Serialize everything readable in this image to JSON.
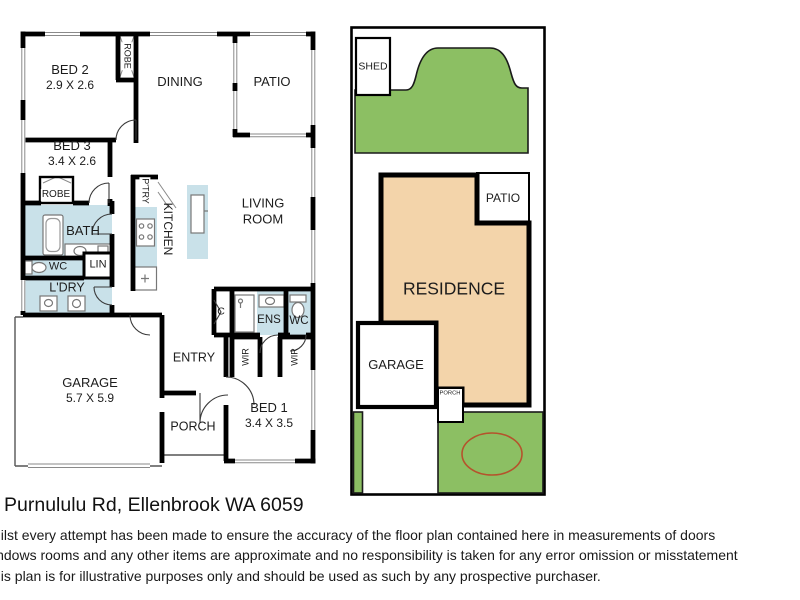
{
  "address": "Purnululu Rd, Ellenbrook WA 6059",
  "disclaimer": {
    "line1": "hilst every attempt has been made to ensure the accuracy of the floor plan contained here in measurements of doors",
    "line2": "indows rooms and any other items are approximate and no responsibility is taken for any error omission or misstatement",
    "line3": "his plan is for illustrative purposes only and should be used as such by any prospective purchaser."
  },
  "floor_plan": {
    "bed2": {
      "name": "BED 2",
      "dims": "2.9 X 2.6"
    },
    "bed3": {
      "name": "BED 3",
      "dims": "3.4 X 2.6"
    },
    "bed1": {
      "name": "BED 1",
      "dims": "3.4 X 3.5"
    },
    "garage": {
      "name": "GARAGE",
      "dims": "5.7 X 5.9"
    },
    "dining": "DINING",
    "patio": "PATIO",
    "living": "LIVING ROOM",
    "kitchen": "KITCHEN",
    "pantry": "P'TRY",
    "robe_top": "ROBE",
    "robe_bed3": "ROBE",
    "bath": "BATH",
    "wc": "WC",
    "linen": "LIN",
    "laundry": "L'DRY",
    "cupboard": "C",
    "ensuite": "ENS",
    "ens_wc": "WC",
    "wir_left": "WIR",
    "wir_right": "WIR",
    "entry": "ENTRY",
    "porch": "PORCH"
  },
  "site_plan": {
    "shed": "SHED",
    "patio": "PATIO",
    "residence": "RESIDENCE",
    "garage": "GARAGE",
    "porch": "PORCH"
  },
  "colors": {
    "wall": "#000000",
    "wet_area": "#c9e1e9",
    "lawn": "#8cbf63",
    "residence": "#f3d4aa",
    "garden_ellipse": "#b5532c"
  }
}
